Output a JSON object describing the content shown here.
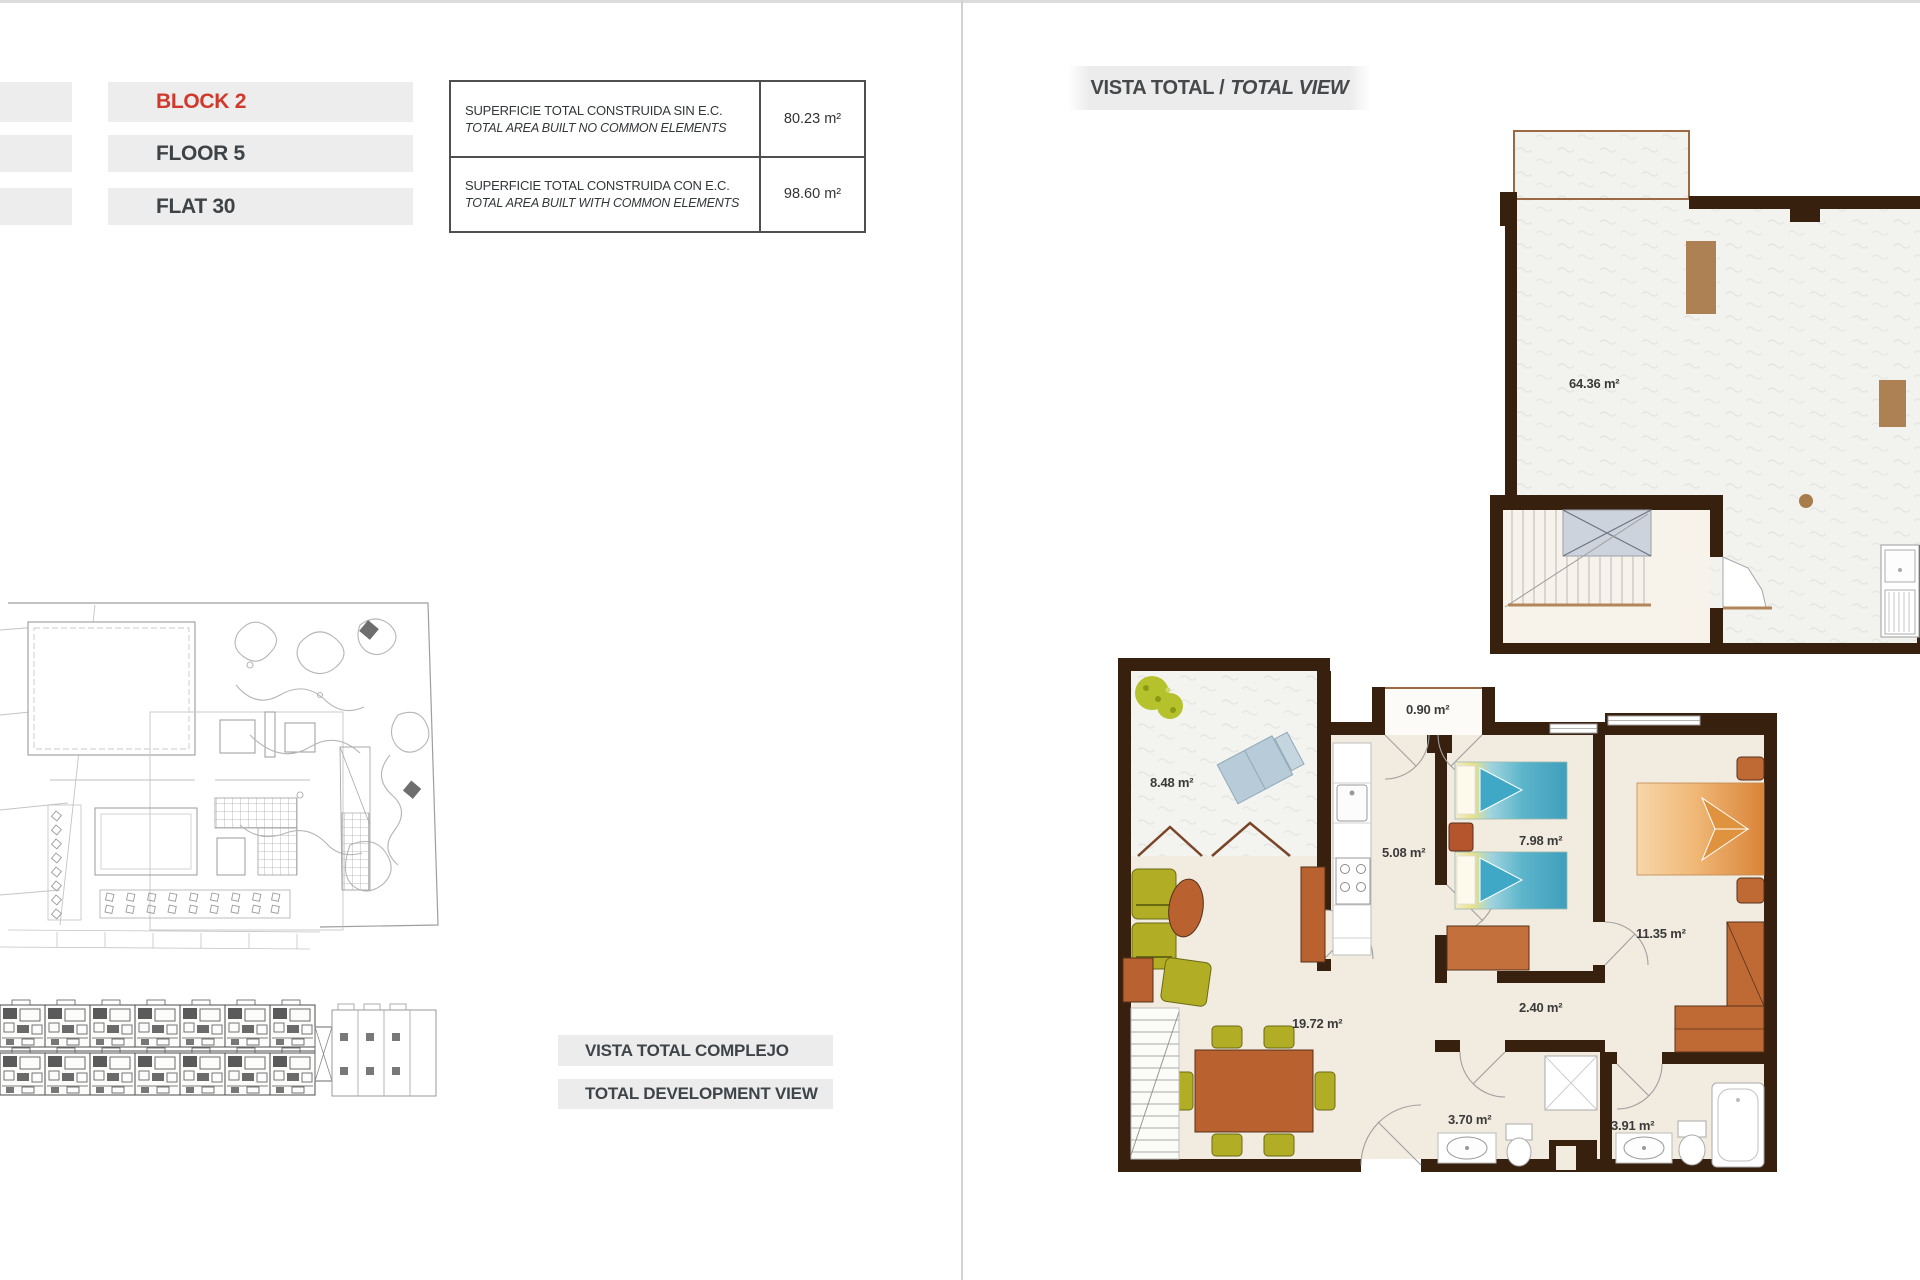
{
  "unit_info": {
    "block": "BLOCK 2",
    "floor": "FLOOR 5",
    "flat": "FLAT 30"
  },
  "area_table": {
    "rows": [
      {
        "es": "SUPERFICIE TOTAL CONSTRUIDA SIN E.C.",
        "en": "TOTAL AREA BUILT NO COMMON ELEMENTS",
        "value": "80.23 m²"
      },
      {
        "es": "SUPERFICIE TOTAL CONSTRUIDA CON E.C.",
        "en": "TOTAL AREA BUILT WITH COMMON ELEMENTS",
        "value": "98.60 m²"
      }
    ]
  },
  "headers": {
    "total_view_es": "VISTA TOTAL /",
    "total_view_en": "TOTAL VIEW",
    "development_view_es": "VISTA TOTAL COMPLEJO",
    "development_view_en": "TOTAL DEVELOPMENT VIEW"
  },
  "floor_plan": {
    "upper": {
      "solarium_area": "64.36 m²"
    },
    "main": {
      "terrace_area": "8.48 m²",
      "closet_area": "0.90 m²",
      "kitchen_area": "5.08 m²",
      "bedroom2_area": "7.98 m²",
      "bedroom1_area": "11.35 m²",
      "living_area": "19.72 m²",
      "hall_area": "2.40 m²",
      "bath1_area": "3.70 m²",
      "bath2_area": "3.91 m²"
    }
  },
  "colors": {
    "accent_red": "#cf3a2c",
    "wall_brown": "#38200f",
    "bar_gray": "#ededed",
    "furniture_terracotta": "#b9622f",
    "chair_olive": "#b1ae26",
    "bed_blue": "#49aac4",
    "bed_orange": "#dd8f43"
  }
}
